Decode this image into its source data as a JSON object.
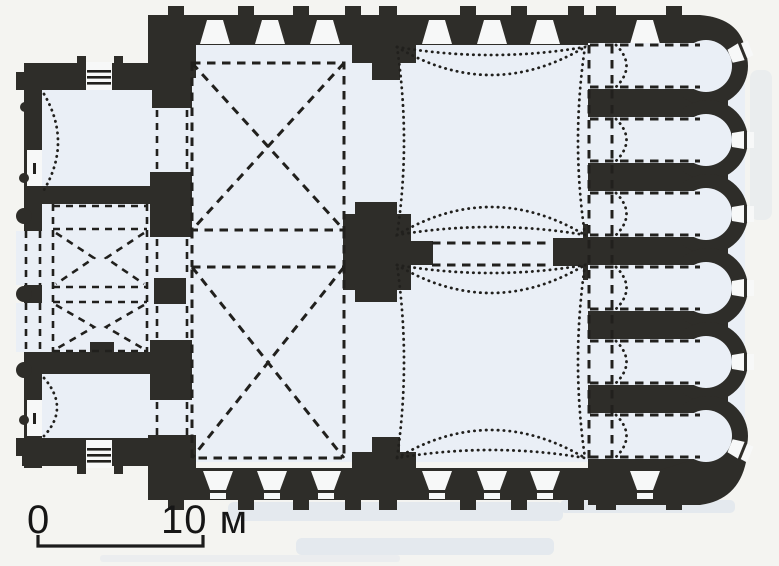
{
  "figure": {
    "kind": "scanned architectural floor plan",
    "subject": "Church plan: western narthex with groin-vaulted cells, two cross-vaulted (X) bays, two domed (sail-vault) bays, and six barrel-vaulted apsed chambers on the east with scalloped exterior wall"
  },
  "scale_bar": {
    "start_label": "0",
    "end_label": "10 м"
  },
  "plan": {
    "cross_vaulted_bays": 2,
    "domed_bays": 2,
    "apse_chambers": 6,
    "narthex_groin_cells": 2,
    "facade_windows_top": 7,
    "facade_windows_bottom": 7,
    "west_facade_columns": 3
  },
  "colors": {
    "paper": "#f4f4f1",
    "interior": "#eaeff6",
    "wall": "#2e2d29",
    "ink": "#21201d",
    "void": "#f7f8f8",
    "smudge": "#b9cbe4"
  }
}
